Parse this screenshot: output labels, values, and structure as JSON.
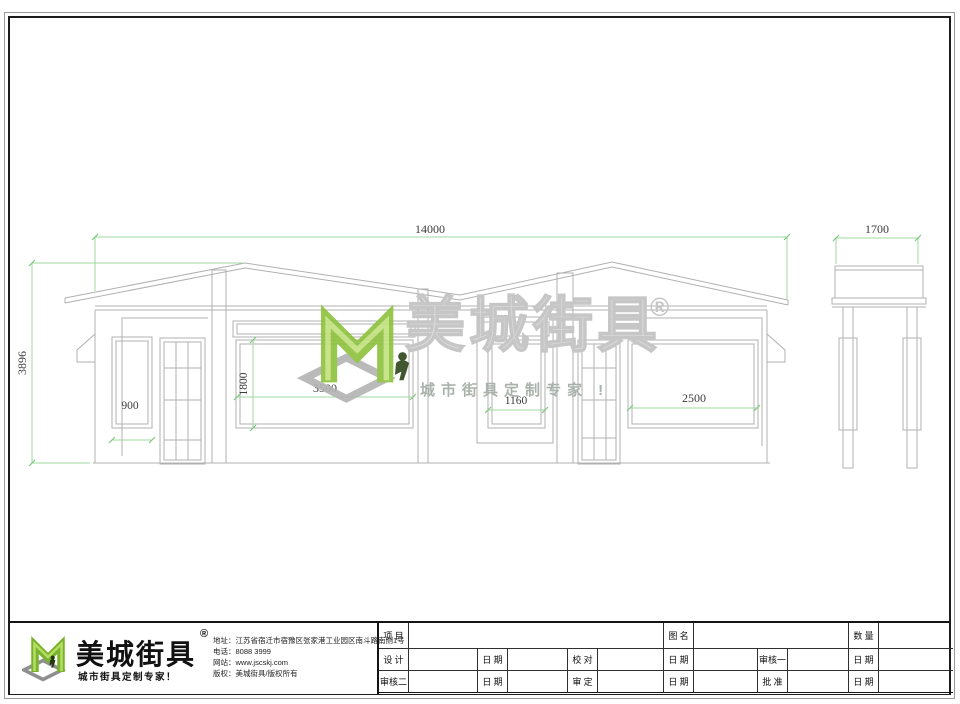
{
  "dims": {
    "overall_width": "14000",
    "side_width": "1700",
    "overall_height": "3896",
    "left_window_width": "900",
    "mid_window_height": "1800",
    "mid_window_width": "3500",
    "center_window_width": "1160",
    "right_window_width": "2500"
  },
  "watermark": {
    "brand": "美城街具",
    "reg": "®",
    "tagline": "城市街具定制专家 !"
  },
  "footer": {
    "brand": "美城街具",
    "reg": "®",
    "tagline": "城市街具定制专家！",
    "contact": [
      "地址：江苏省宿迁市宿豫区张家港工业园区南斗路南侧1号",
      "电话：8088 3999",
      "网站：www.jscskj.com",
      "版权：美城街具/版权所有"
    ],
    "table": {
      "r1c1": "项 目",
      "r1c2": "图 名",
      "r1c3": "数 量",
      "r2c1": "设 计",
      "r2c2": "日 期",
      "r2c3": "校 对",
      "r2c4": "日 期",
      "r2c5": "审核一",
      "r2c6": "日 期",
      "r3c1": "审核二",
      "r3c2": "日 期",
      "r3c3": "审 定",
      "r3c4": "日 期",
      "r3c5": "批 准",
      "r3c6": "日 期"
    }
  }
}
